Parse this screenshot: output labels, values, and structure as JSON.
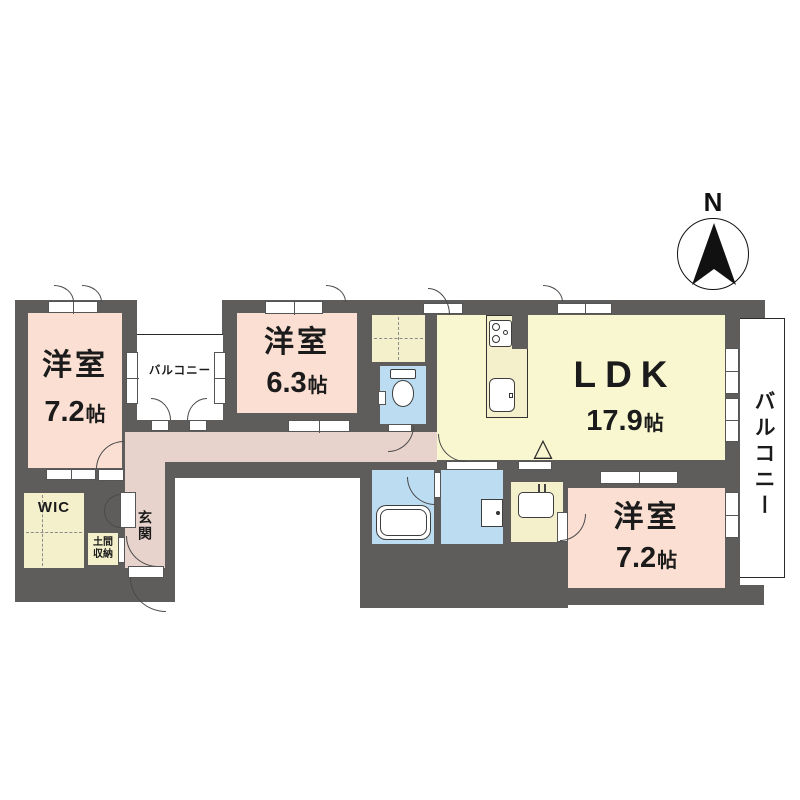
{
  "compass": {
    "north_label": "N"
  },
  "rooms": {
    "bedroom_tl": {
      "name": "洋室",
      "size": "7.2",
      "unit": "帖"
    },
    "bedroom_top": {
      "name": "洋室",
      "size": "6.3",
      "unit": "帖"
    },
    "ldk": {
      "name": "LDK",
      "size": "17.9",
      "unit": "帖"
    },
    "bedroom_br": {
      "name": "洋室",
      "size": "7.2",
      "unit": "帖"
    },
    "wic": {
      "label": "WIC"
    },
    "doma": {
      "line1": "土間",
      "line2": "収納"
    },
    "genkan": {
      "label": "玄関"
    },
    "balcony_inner": {
      "label": "バルコニー"
    },
    "balcony_right": {
      "label": "バルコニー"
    }
  },
  "glyphs": {
    "alarm_triangle": "△"
  },
  "colors": {
    "wall": "#5f5d5b",
    "bedroom": "#fadfd2",
    "corridor": "#e8d2cc",
    "ldk": "#f9f7d0",
    "closet": "#f3f0cb",
    "water": "#bcdcf2",
    "outline": "#2b2b2b",
    "text": "#1b1b1b"
  }
}
